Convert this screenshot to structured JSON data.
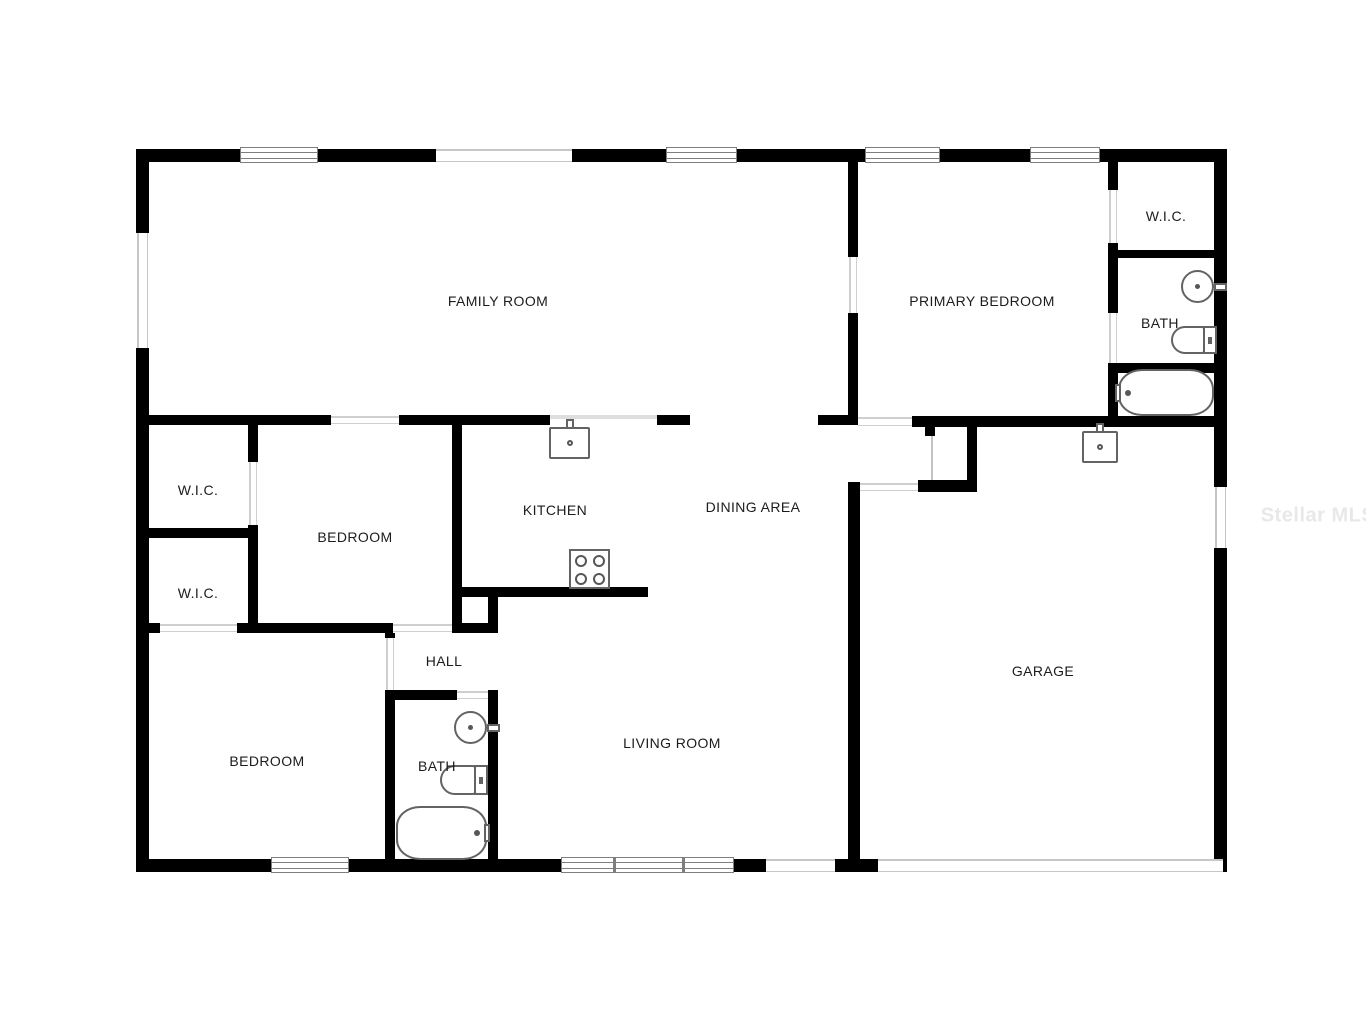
{
  "watermark": {
    "text": "Stellar MLS",
    "cx": 1318,
    "cy": 516,
    "color": "#e8e8e8"
  },
  "plan": {
    "background": "#ffffff",
    "wall_color": "#000000",
    "label_color": "#1c1c1c",
    "window_frame_color": "#7e7e7e",
    "opening_line_color": "#c6c6c6",
    "fixture_line_color": "#636363",
    "rooms": [
      {
        "name": "family-room",
        "label": "FAMILY ROOM",
        "cx": 498,
        "cy": 301
      },
      {
        "name": "primary-bedroom",
        "label": "PRIMARY BEDROOM",
        "cx": 982,
        "cy": 301
      },
      {
        "name": "wic-primary",
        "label": "W.I.C.",
        "cx": 1166,
        "cy": 216
      },
      {
        "name": "bath-primary",
        "label": "BATH",
        "cx": 1160,
        "cy": 323
      },
      {
        "name": "kitchen",
        "label": "KITCHEN",
        "cx": 555,
        "cy": 510
      },
      {
        "name": "dining-area",
        "label": "DINING AREA",
        "cx": 753,
        "cy": 507
      },
      {
        "name": "bedroom-middle",
        "label": "BEDROOM",
        "cx": 355,
        "cy": 537
      },
      {
        "name": "wic-upper",
        "label": "W.I.C.",
        "cx": 198,
        "cy": 490
      },
      {
        "name": "wic-lower",
        "label": "W.I.C.",
        "cx": 198,
        "cy": 593
      },
      {
        "name": "bedroom-lower",
        "label": "BEDROOM",
        "cx": 267,
        "cy": 761
      },
      {
        "name": "hall",
        "label": "HALL",
        "cx": 444,
        "cy": 661
      },
      {
        "name": "bath-hall",
        "label": "BATH",
        "cx": 437,
        "cy": 766
      },
      {
        "name": "living-room",
        "label": "LIVING ROOM",
        "cx": 672,
        "cy": 743
      },
      {
        "name": "garage",
        "label": "GARAGE",
        "cx": 1043,
        "cy": 671
      }
    ],
    "walls": [
      [
        136,
        149,
        104,
        13
      ],
      [
        318,
        149,
        118,
        13
      ],
      [
        572,
        149,
        94,
        13
      ],
      [
        737,
        149,
        128,
        13
      ],
      [
        940,
        149,
        90,
        13
      ],
      [
        1100,
        149,
        127,
        13
      ],
      [
        136,
        859,
        135,
        13
      ],
      [
        349,
        859,
        212,
        13
      ],
      [
        734,
        859,
        32,
        13
      ],
      [
        835,
        859,
        43,
        13
      ],
      [
        1214,
        859,
        13,
        13
      ],
      [
        136,
        149,
        13,
        84
      ],
      [
        136,
        348,
        13,
        524
      ],
      [
        1214,
        149,
        13,
        338
      ],
      [
        1214,
        548,
        13,
        324
      ],
      [
        143,
        415,
        188,
        10
      ],
      [
        399,
        415,
        151,
        10
      ],
      [
        657,
        415,
        33,
        10
      ],
      [
        818,
        415,
        40,
        10
      ],
      [
        248,
        425,
        10,
        37
      ],
      [
        248,
        525,
        10,
        108
      ],
      [
        143,
        528,
        115,
        10
      ],
      [
        452,
        425,
        10,
        208
      ],
      [
        462,
        587,
        186,
        10
      ],
      [
        488,
        597,
        10,
        36
      ],
      [
        462,
        623,
        36,
        10
      ],
      [
        143,
        623,
        17,
        10
      ],
      [
        237,
        623,
        156,
        10
      ],
      [
        385,
        623,
        10,
        15
      ],
      [
        385,
        690,
        10,
        170
      ],
      [
        395,
        690,
        62,
        10
      ],
      [
        488,
        690,
        10,
        170
      ],
      [
        848,
        160,
        10,
        97
      ],
      [
        848,
        313,
        10,
        112
      ],
      [
        912,
        416,
        315,
        11
      ],
      [
        967,
        426,
        10,
        56
      ],
      [
        918,
        480,
        59,
        12
      ],
      [
        925,
        426,
        10,
        10
      ],
      [
        1108,
        160,
        10,
        30
      ],
      [
        1108,
        243,
        10,
        70
      ],
      [
        1108,
        363,
        10,
        64
      ],
      [
        1108,
        250,
        119,
        8
      ],
      [
        1118,
        363,
        109,
        10
      ],
      [
        848,
        482,
        12,
        390
      ]
    ],
    "windows": [
      {
        "x": 240,
        "y": 147,
        "w": 78,
        "h": 16,
        "dividers": []
      },
      {
        "x": 666,
        "y": 147,
        "w": 71,
        "h": 16,
        "dividers": []
      },
      {
        "x": 865,
        "y": 147,
        "w": 75,
        "h": 16,
        "dividers": []
      },
      {
        "x": 1030,
        "y": 147,
        "w": 70,
        "h": 16,
        "dividers": []
      },
      {
        "x": 271,
        "y": 857,
        "w": 78,
        "h": 16,
        "dividers": []
      },
      {
        "x": 561,
        "y": 857,
        "w": 173,
        "h": 16,
        "dividers": [
          51,
          120
        ]
      }
    ],
    "openings": [
      {
        "x": 436,
        "y": 149,
        "w": 136,
        "h": 13
      },
      {
        "x": 137,
        "y": 233,
        "w": 11,
        "h": 115
      },
      {
        "x": 1215,
        "y": 487,
        "w": 11,
        "h": 61
      },
      {
        "x": 766,
        "y": 859,
        "w": 69,
        "h": 13
      },
      {
        "x": 878,
        "y": 859,
        "w": 345,
        "h": 13
      }
    ],
    "door_gaps": [
      {
        "x": 331,
        "y": 415,
        "w": 68,
        "h": 10
      },
      {
        "x": 160,
        "y": 623,
        "w": 77,
        "h": 10
      },
      {
        "x": 393,
        "y": 623,
        "w": 59,
        "h": 10
      },
      {
        "x": 457,
        "y": 690,
        "w": 31,
        "h": 10
      },
      {
        "x": 858,
        "y": 416,
        "w": 54,
        "h": 11
      },
      {
        "x": 860,
        "y": 482,
        "w": 58,
        "h": 10
      },
      {
        "x": 248,
        "y": 462,
        "w": 10,
        "h": 63
      },
      {
        "x": 385,
        "y": 638,
        "w": 10,
        "h": 52
      },
      {
        "x": 848,
        "y": 257,
        "w": 10,
        "h": 56
      },
      {
        "x": 1108,
        "y": 190,
        "w": 10,
        "h": 53
      },
      {
        "x": 1108,
        "y": 313,
        "w": 10,
        "h": 50
      }
    ],
    "extra_lines": [
      {
        "x": 931,
        "y": 436,
        "w": 2,
        "h": 44,
        "color": "#c4c4c4"
      },
      {
        "x": 550,
        "y": 415,
        "w": 107,
        "h": 4,
        "color": "#dedede"
      }
    ],
    "fixtures": [
      {
        "name": "kitchen-sink",
        "type": "sink-square",
        "x": 549,
        "y": 427,
        "w": 41,
        "h": 32
      },
      {
        "name": "kitchen-stove",
        "type": "stove",
        "x": 569,
        "y": 549,
        "w": 41,
        "h": 40
      },
      {
        "name": "garage-sink",
        "type": "sink-square",
        "x": 1082,
        "y": 431,
        "w": 36,
        "h": 32
      },
      {
        "name": "primary-bath-sink",
        "type": "sink-round",
        "x": 1181,
        "y": 270,
        "w": 33,
        "h": 33,
        "faucet": "right"
      },
      {
        "name": "primary-bath-toilet",
        "type": "toilet",
        "x": 1171,
        "y": 326,
        "w": 46,
        "h": 28
      },
      {
        "name": "primary-bath-tub",
        "type": "tub",
        "x": 1118,
        "y": 369,
        "w": 96,
        "h": 47,
        "faucet": "left"
      },
      {
        "name": "hall-bath-sink",
        "type": "sink-round",
        "x": 454,
        "y": 711,
        "w": 33,
        "h": 33,
        "faucet": "right"
      },
      {
        "name": "hall-bath-toilet",
        "type": "toilet",
        "x": 440,
        "y": 765,
        "w": 48,
        "h": 30
      },
      {
        "name": "hall-bath-tub",
        "type": "tub",
        "x": 396,
        "y": 806,
        "w": 91,
        "h": 54,
        "faucet": "right"
      }
    ]
  }
}
